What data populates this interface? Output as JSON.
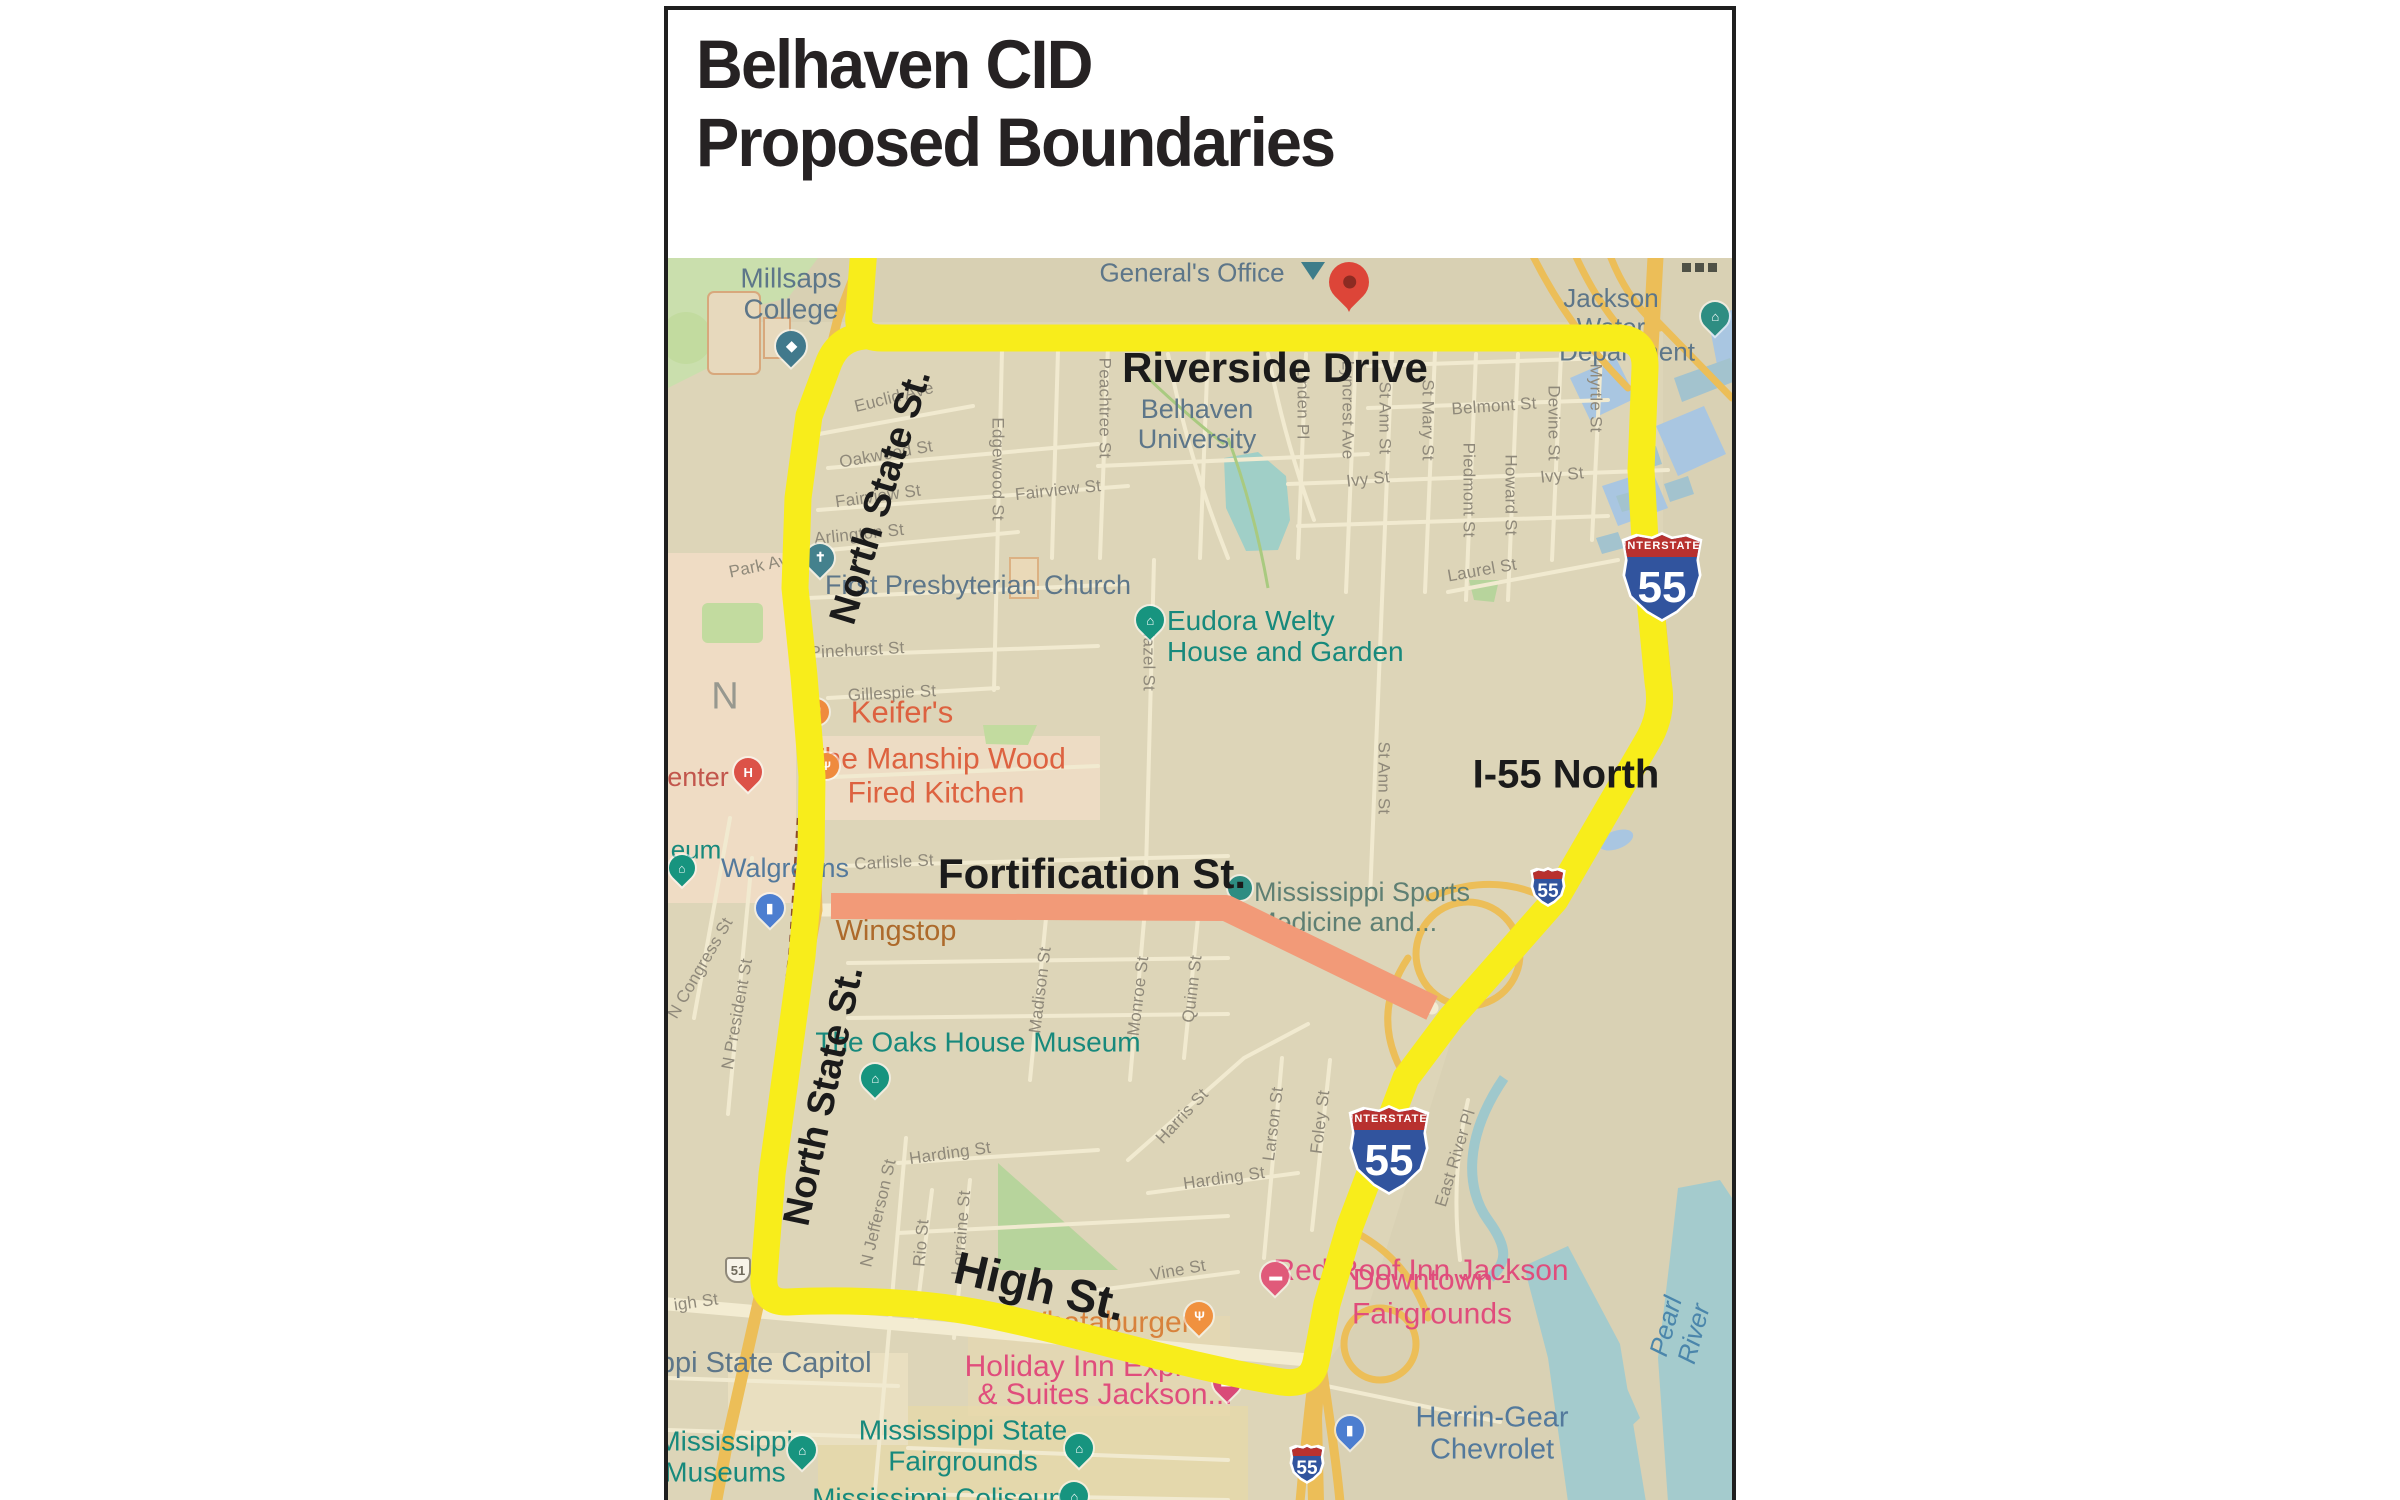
{
  "title": {
    "line1": "Belhaven CID",
    "line2": "Proposed Boundaries"
  },
  "palette": {
    "boundary_yellow": "#f8ed1b",
    "fortification_orange": "#f29a78",
    "map_background": "#ddd5b8",
    "road_cream": "#f3ecd2",
    "highway_amber": "#ecbe58",
    "park_green": "#c9dfa9",
    "water_blue": "#a9c6e1",
    "water_teal": "#a4cbcd",
    "street_gray": "#8f897a",
    "poi_slate": "#5d7689",
    "poi_teal": "#17897c",
    "poi_pink": "#e04d7c",
    "annotation_black": "#1b1b1b",
    "shield_blue": "#31549e",
    "shield_red": "#b8312f"
  },
  "map": {
    "annotations": [
      {
        "id": "anno-riverside-drive",
        "t": "Riverside Drive",
        "x": 607,
        "y": 110,
        "rot": 0,
        "fs": 42
      },
      {
        "id": "anno-north-state-st-upper",
        "t": "North State St.",
        "x": 213,
        "y": 239,
        "rot": -73,
        "fs": 38
      },
      {
        "id": "anno-i55-north",
        "t": "I-55 North",
        "x": 898,
        "y": 517,
        "rot": 0,
        "fs": 40
      },
      {
        "id": "anno-fortification-st",
        "t": "Fortification St.",
        "x": 424,
        "y": 616,
        "rot": 0,
        "fs": 42
      },
      {
        "id": "anno-north-state-st-lower",
        "t": "North State St.",
        "x": 156,
        "y": 838,
        "rot": -78,
        "fs": 38
      },
      {
        "id": "anno-high-st",
        "t": "High St.",
        "x": 372,
        "y": 1028,
        "rot": 13,
        "fs": 46
      }
    ],
    "street_labels": [
      {
        "id": "street-park-ave",
        "t": "Park Ave",
        "x": 95,
        "y": 307,
        "rot": -12
      },
      {
        "id": "street-euclid-ave",
        "t": "Euclid Ave",
        "x": 226,
        "y": 139,
        "rot": -14
      },
      {
        "id": "street-oakwood-st",
        "t": "Oakwood St",
        "x": 218,
        "y": 196,
        "rot": -10
      },
      {
        "id": "street-fairview-st-left",
        "t": "Fairview St",
        "x": 210,
        "y": 238,
        "rot": -8
      },
      {
        "id": "street-fairview-st-right",
        "t": "Fairview St",
        "x": 390,
        "y": 232,
        "rot": -6
      },
      {
        "id": "street-arlington-st",
        "t": "Arlington St",
        "x": 191,
        "y": 276,
        "rot": -6
      },
      {
        "id": "street-pinehurst-st",
        "t": "Pinehurst St",
        "x": 189,
        "y": 392,
        "rot": -3
      },
      {
        "id": "street-gillespie-st",
        "t": "Gillespie St",
        "x": 224,
        "y": 435,
        "rot": -3
      },
      {
        "id": "street-carlisle-st",
        "t": "Carlisle St",
        "x": 226,
        "y": 604,
        "rot": -3
      },
      {
        "id": "street-edgewood-st",
        "t": "Edgewood St",
        "x": 330,
        "y": 211,
        "rot": 90
      },
      {
        "id": "street-peachtree-st",
        "t": "Peachtree St",
        "x": 437,
        "y": 150,
        "rot": 90
      },
      {
        "id": "street-hazel-st",
        "t": "Hazel St",
        "x": 481,
        "y": 400,
        "rot": 90
      },
      {
        "id": "street-linden-pl",
        "t": "Linden Pl",
        "x": 635,
        "y": 145,
        "rot": 90
      },
      {
        "id": "street-lyncrest-ave",
        "t": "Lyncrest Ave",
        "x": 680,
        "y": 152,
        "rot": 90
      },
      {
        "id": "street-st-ann-st-upper",
        "t": "St Ann St",
        "x": 717,
        "y": 160,
        "rot": 90
      },
      {
        "id": "street-st-mary-st",
        "t": "St Mary St",
        "x": 760,
        "y": 162,
        "rot": 90
      },
      {
        "id": "street-piedmont-st",
        "t": "Piedmont St",
        "x": 801,
        "y": 232,
        "rot": 90
      },
      {
        "id": "street-howard-st",
        "t": "Howard St",
        "x": 843,
        "y": 237,
        "rot": 90
      },
      {
        "id": "street-devine-st",
        "t": "Devine St",
        "x": 886,
        "y": 165,
        "rot": 90
      },
      {
        "id": "street-myrtle-st",
        "t": "Myrtle St",
        "x": 928,
        "y": 140,
        "rot": 90
      },
      {
        "id": "street-belmont-st",
        "t": "Belmont St",
        "x": 826,
        "y": 148,
        "rot": -4
      },
      {
        "id": "street-ivy-st-left",
        "t": "Ivy St",
        "x": 700,
        "y": 221,
        "rot": -6
      },
      {
        "id": "street-ivy-st-right",
        "t": "Ivy St",
        "x": 894,
        "y": 217,
        "rot": -6
      },
      {
        "id": "street-laurel-st",
        "t": "Laurel St",
        "x": 814,
        "y": 312,
        "rot": -10
      },
      {
        "id": "street-st-ann-st-lower",
        "t": "St Ann St",
        "x": 716,
        "y": 520,
        "rot": 90
      },
      {
        "id": "street-madison-st",
        "t": "Madison St",
        "x": 372,
        "y": 732,
        "rot": -83
      },
      {
        "id": "street-monroe-st",
        "t": "Monroe St",
        "x": 470,
        "y": 738,
        "rot": -83
      },
      {
        "id": "street-quinn-st",
        "t": "Quinn St",
        "x": 524,
        "y": 731,
        "rot": -83
      },
      {
        "id": "street-n-congress-st",
        "t": "N Congress St",
        "x": 32,
        "y": 710,
        "rot": -60
      },
      {
        "id": "street-n-president-st",
        "t": "N President St",
        "x": 69,
        "y": 756,
        "rot": -80
      },
      {
        "id": "street-n-jefferson-st",
        "t": "N Jefferson St",
        "x": 210,
        "y": 955,
        "rot": -77
      },
      {
        "id": "street-rio-st",
        "t": "Rio St",
        "x": 253,
        "y": 985,
        "rot": -85
      },
      {
        "id": "street-lorraine-st",
        "t": "Lorraine St",
        "x": 293,
        "y": 975,
        "rot": -85
      },
      {
        "id": "street-harding-st-left",
        "t": "Harding St",
        "x": 282,
        "y": 895,
        "rot": -8
      },
      {
        "id": "street-harding-st-right",
        "t": "Harding St",
        "x": 556,
        "y": 920,
        "rot": -8
      },
      {
        "id": "street-harris-st",
        "t": "Harris St",
        "x": 514,
        "y": 858,
        "rot": -47
      },
      {
        "id": "street-larson-st",
        "t": "Larson St",
        "x": 605,
        "y": 866,
        "rot": -83
      },
      {
        "id": "street-foley-st",
        "t": "Foley St",
        "x": 652,
        "y": 864,
        "rot": -83
      },
      {
        "id": "street-east-river-pl",
        "t": "East River Pl",
        "x": 787,
        "y": 900,
        "rot": -73
      },
      {
        "id": "street-vine-st",
        "t": "Vine St",
        "x": 510,
        "y": 1012,
        "rot": -10
      },
      {
        "id": "street-high-st-gray",
        "t": "igh St",
        "x": 28,
        "y": 1044,
        "rot": -8
      }
    ],
    "poi_labels": [
      {
        "id": "poi-millsaps-college",
        "t": "Millsaps\nCollege",
        "x": 123,
        "y": 36,
        "cls": "slate",
        "fs": 28
      },
      {
        "id": "poi-generals-office",
        "t": "General's Office",
        "x": 524,
        "y": 15,
        "cls": "slate",
        "fs": 26
      },
      {
        "id": "poi-jackson-water",
        "t": "Jackson Water",
        "x": 943,
        "y": 55,
        "cls": "slate",
        "fs": 26
      },
      {
        "id": "poi-department",
        "t": "Department",
        "x": 959,
        "y": 94,
        "cls": "slate",
        "fs": 26
      },
      {
        "id": "poi-belhaven-university",
        "t": "Belhaven\nUniversity",
        "x": 529,
        "y": 166,
        "cls": "slate",
        "fs": 27
      },
      {
        "id": "poi-first-presbyterian",
        "t": "First Presbyterian Church",
        "x": 310,
        "y": 327,
        "cls": "slate",
        "fs": 27
      },
      {
        "id": "poi-walgreens",
        "t": "Walgreens",
        "x": 117,
        "y": 610,
        "cls": "blue",
        "fs": 27
      },
      {
        "id": "poi-state-capitol",
        "t": "ippi State Capitol",
        "x": 94,
        "y": 1105,
        "cls": "slate",
        "fs": 29
      },
      {
        "id": "poi-herrin-gear",
        "t": "Herrin-Gear Chevrolet",
        "x": 824,
        "y": 1176,
        "cls": "blue",
        "fs": 29
      },
      {
        "id": "poi-district-en",
        "t": "E N",
        "x": 31,
        "y": 439,
        "cls": "gray-big"
      },
      {
        "id": "poi-pearl-river",
        "t": "Pearl River",
        "x": 1012,
        "y": 1072,
        "cls": "pearl",
        "rot": -75
      },
      {
        "id": "poi-eudora-welty",
        "t": "Eudora Welty\nHouse and Garden",
        "x": 499,
        "y": 347,
        "cls": "teal",
        "la": 1,
        "ta": "left",
        "fs": 28
      },
      {
        "id": "poi-oaks-house",
        "t": "The Oaks House Museum",
        "x": 310,
        "y": 784,
        "cls": "teal",
        "fs": 28
      },
      {
        "id": "poi-miss-sports",
        "t": "Mississippi Sports\nMedicine and...",
        "x": 586,
        "y": 619,
        "cls": "tealgray",
        "la": 1,
        "fs": 27
      },
      {
        "id": "poi-miss-museums",
        "t": "Mississippi\nMuseums",
        "x": 57,
        "y": 1199,
        "cls": "teal",
        "fs": 28
      },
      {
        "id": "poi-fairgrounds",
        "t": "Mississippi State\nFairgrounds",
        "x": 295,
        "y": 1188,
        "cls": "teal",
        "fs": 28
      },
      {
        "id": "poi-coliseum",
        "t": "Mississippi Coliseum",
        "x": 274,
        "y": 1240,
        "cls": "teal",
        "fs": 28
      },
      {
        "id": "poi-eum-fragment",
        "t": "eum",
        "x": 28,
        "y": 592,
        "cls": "teal",
        "fs": 26
      },
      {
        "id": "poi-keifers",
        "t": "Keifer's",
        "x": 234,
        "y": 455,
        "cls": "coral",
        "fs": 31
      },
      {
        "id": "poi-manship",
        "t": "The Manship Wood\nFired Kitchen",
        "x": 268,
        "y": 518,
        "cls": "coral",
        "fs": 30
      },
      {
        "id": "poi-wingstop",
        "t": "Wingstop",
        "x": 228,
        "y": 673,
        "cls": "rust"
      },
      {
        "id": "poi-whataburger",
        "t": "Whataburger",
        "x": 437,
        "y": 1065,
        "cls": "orange"
      },
      {
        "id": "poi-red-roof-1",
        "t": "Red Roof Inn Jackson",
        "x": 753,
        "y": 1013,
        "cls": "pink"
      },
      {
        "id": "poi-red-roof-2",
        "t": "Downtown - Fairgrounds",
        "x": 764,
        "y": 1039,
        "cls": "pink"
      },
      {
        "id": "poi-holiday-inn-1",
        "t": "Holiday Inn Express",
        "x": 430,
        "y": 1109,
        "cls": "pink"
      },
      {
        "id": "poi-holiday-inn-2",
        "t": "& Suites Jackson...",
        "x": 437,
        "y": 1137,
        "cls": "pink"
      },
      {
        "id": "poi-enter-fragment",
        "t": "enter",
        "x": 30,
        "y": 519,
        "cls": "red"
      }
    ],
    "pins": [
      {
        "id": "millsaps-pin",
        "type": "pin",
        "x": 123,
        "y": 88,
        "color": "#41798c",
        "glyph": "◆",
        "size": 30
      },
      {
        "id": "generals-office-marker",
        "type": "tri",
        "x": 645,
        "y": 4,
        "color": "#3e7d8a"
      },
      {
        "id": "dropped-red-pin",
        "type": "redpin",
        "x": 681,
        "y": 24
      },
      {
        "id": "jackson-water-pin",
        "type": "pin",
        "x": 1047,
        "y": 58,
        "color": "#2e8d82",
        "glyph": "⌂",
        "size": 28
      },
      {
        "id": "church-pin",
        "type": "pin",
        "x": 152,
        "y": 300,
        "color": "#44818d",
        "glyph": "✝",
        "size": 28
      },
      {
        "id": "welty-pin",
        "type": "pin",
        "x": 482,
        "y": 362,
        "color": "#17947f",
        "glyph": "⌂",
        "size": 28
      },
      {
        "id": "keifers-pin",
        "type": "circ",
        "x": 148,
        "y": 454,
        "color": "#ef8b3e",
        "glyph": "Ψ",
        "size": 26
      },
      {
        "id": "manship-pin",
        "type": "circ",
        "x": 158,
        "y": 508,
        "color": "#ef8b3e",
        "glyph": "Ψ",
        "size": 26
      },
      {
        "id": "hospital-pin",
        "type": "pin",
        "x": 80,
        "y": 514,
        "color": "#dc5248",
        "glyph": "H",
        "size": 28
      },
      {
        "id": "museum-edge-pin",
        "type": "pin",
        "x": 14,
        "y": 610,
        "color": "#17947f",
        "glyph": "⌂",
        "size": 26
      },
      {
        "id": "walgreens-pin",
        "type": "pin",
        "x": 102,
        "y": 650,
        "color": "#4c7ed0",
        "glyph": "▮",
        "size": 28
      },
      {
        "id": "sports-medicine-pin",
        "type": "circ",
        "x": 572,
        "y": 630,
        "color": "#2e8d82",
        "glyph": "",
        "size": 24
      },
      {
        "id": "oaks-pin",
        "type": "pin",
        "x": 207,
        "y": 820,
        "color": "#17947f",
        "glyph": "⌂",
        "size": 28
      },
      {
        "id": "red-roof-pin",
        "type": "pin",
        "x": 607,
        "y": 1018,
        "color": "#e05a7a",
        "glyph": "▬",
        "size": 28
      },
      {
        "id": "whataburger-pin",
        "type": "pin",
        "x": 531,
        "y": 1058,
        "color": "#f0913f",
        "glyph": "Ψ",
        "size": 28
      },
      {
        "id": "holiday-inn-pin",
        "type": "pin",
        "x": 559,
        "y": 1124,
        "color": "#d94a78",
        "glyph": "▬",
        "size": 28
      },
      {
        "id": "miss-museums-pin",
        "type": "pin",
        "x": 134,
        "y": 1192,
        "color": "#17947f",
        "glyph": "⌂",
        "size": 28
      },
      {
        "id": "fairgrounds-pin",
        "type": "pin",
        "x": 411,
        "y": 1190,
        "color": "#17947f",
        "glyph": "⌂",
        "size": 28
      },
      {
        "id": "herrin-gear-pin",
        "type": "pin",
        "x": 682,
        "y": 1172,
        "color": "#4c7ed0",
        "glyph": "▮",
        "size": 28
      },
      {
        "id": "coliseum-pin",
        "type": "pin",
        "x": 406,
        "y": 1238,
        "color": "#17947f",
        "glyph": "⌂",
        "size": 28
      }
    ],
    "shields": [
      {
        "id": "i55-shield-north",
        "num": "55",
        "header": "INTERSTATE",
        "kind": "big",
        "x": 994,
        "y": 319
      },
      {
        "id": "i55-shield-south",
        "num": "55",
        "header": "INTERSTATE",
        "kind": "big",
        "x": 721,
        "y": 892
      },
      {
        "id": "i55-shield-small-mid",
        "num": "55",
        "kind": "small",
        "x": 880,
        "y": 629
      },
      {
        "id": "i55-shield-small-bottom",
        "num": "55",
        "kind": "small",
        "x": 639,
        "y": 1206
      },
      {
        "id": "us51-shield",
        "num": "51",
        "kind": "us",
        "x": 70,
        "y": 1012
      }
    ],
    "misc": {
      "corner_dots_count": 3
    }
  }
}
